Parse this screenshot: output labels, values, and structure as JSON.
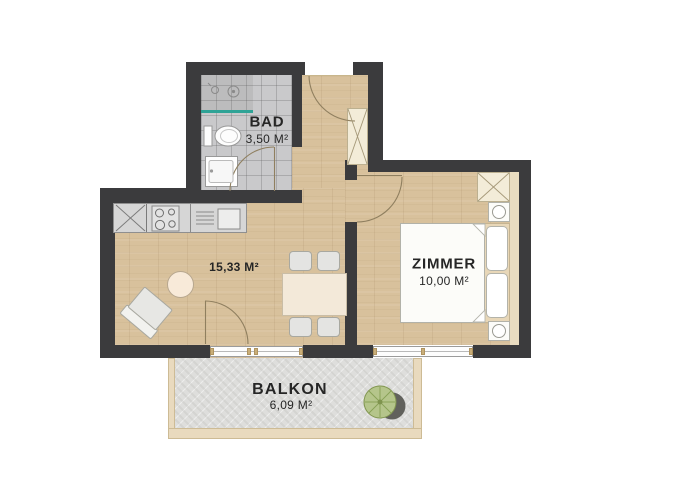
{
  "rooms": {
    "bad": {
      "label": "BAD",
      "area": "3,50 M²"
    },
    "living": {
      "area": "15,33 M²"
    },
    "zimmer": {
      "label": "ZIMMER",
      "area": "10,00 M²"
    },
    "balkon": {
      "label": "BALKON",
      "area": "6,09 M²"
    }
  },
  "colors": {
    "wall": "#3b3b3d",
    "wood_floor": "#d8c19c",
    "bathroom_tile": "#c9c9cb",
    "balcony_concrete": "#dededc",
    "balcony_trim": "#e9dabe",
    "shower_glass": "#2fa396",
    "plant_green": "#b5c58b",
    "text": "#262626"
  },
  "icons": [
    "shower-head-icon",
    "shower-drain-icon",
    "toilet-icon",
    "vanity-sink-icon",
    "fridge-cross-icon",
    "cooktop-icon",
    "kitchen-sink-icon",
    "wardrobe-cross-icon",
    "lamp-icon",
    "plant-icon",
    "door-swing-arc"
  ]
}
